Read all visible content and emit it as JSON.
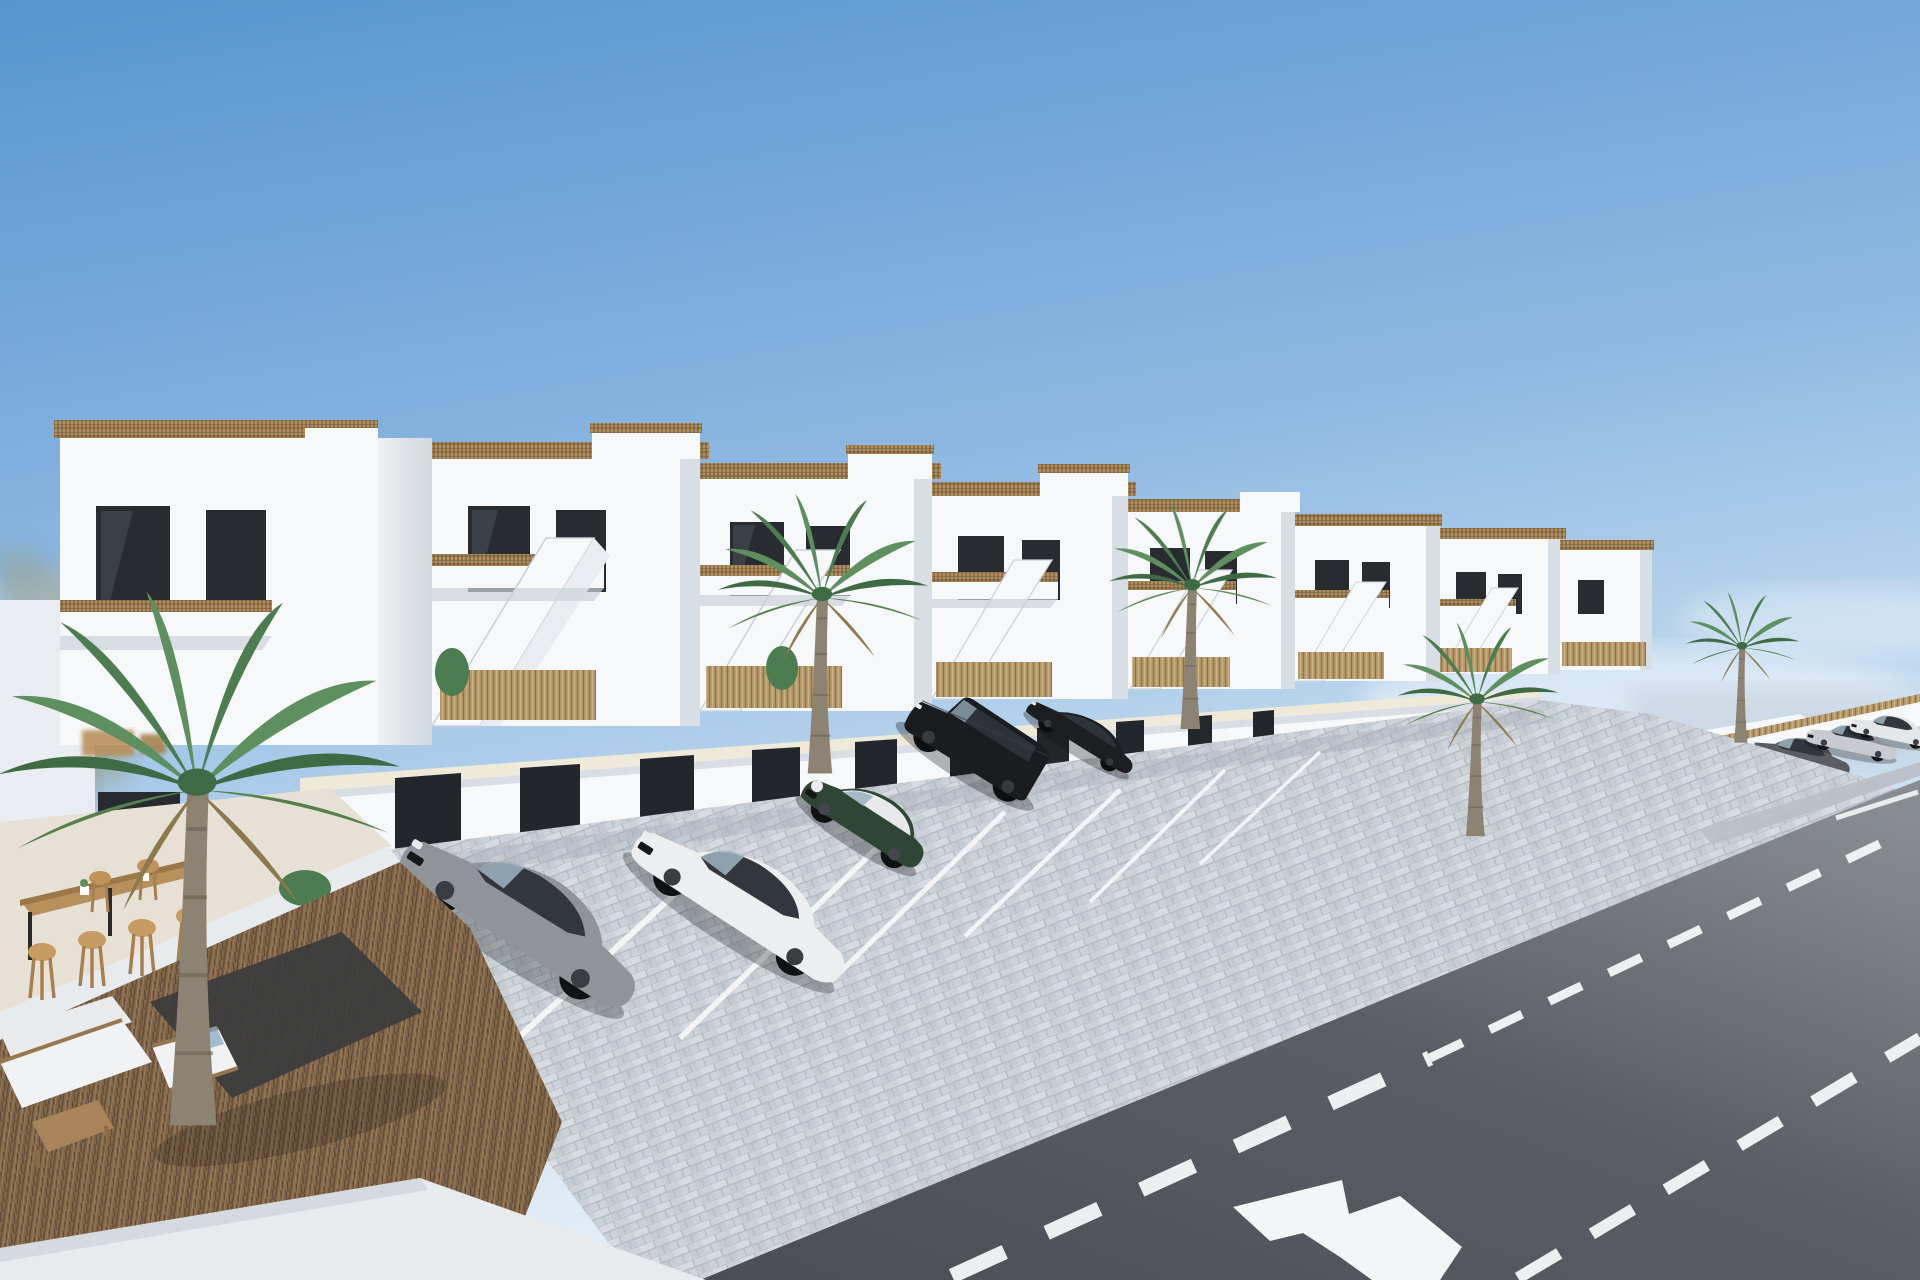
{
  "meta": {
    "description": "3D architectural rendering of a row of modern white two-storey townhouses with roof terraces, external staircases, bamboo balcony railings, garage level with cobbled parking bays, parked cars, palm trees, a private swimming pool with lawn and sun loungers, an outdoor bar terrace, and an asphalt street with white lane markings and a painted merge arrow",
    "image_width": 1920,
    "image_height": 1280,
    "visible_text": "none"
  },
  "palette": {
    "sky-top": "#5795cf",
    "sky-mid": "#9fc4e6",
    "sky-horizon": "#e4eef6",
    "cloud": "#ffffff",
    "hills": "#97a08b",
    "sea-haze": "#c2d2de",
    "building-light": "#f7f8f9",
    "building-mid": "#e9edf1",
    "building-shade": "#d7dee6",
    "building-dark-shade": "#c4ccd7",
    "window-dark": "#282c31",
    "glass-reflect": "#4a535c",
    "railing-tan": "#b4905c",
    "lattice-dark": "#6e5a3e",
    "bamboo": "#b79a6c",
    "garage-door": "#23262a",
    "roof-coping": "#efe9da",
    "terrace-floor": "#e6e1d4",
    "cobble": "#ccd2d8",
    "cobble-gap": "#b3bac1",
    "asphalt-near": "#4b4e54",
    "asphalt-far": "#888d92",
    "road-marking": "#f4f5f6",
    "curb-white": "#e8ebee",
    "sidewalk": "#b9bfc5",
    "palm-green": "#5d8f5f",
    "palm-dark": "#3f6b44",
    "palm-trunk": "#8d8373",
    "brush-brown": "#84674a",
    "brush-dark": "#5d4a36",
    "gravel-dark": "#3b3c3d",
    "wood": "#b9905c",
    "lawn": "#7aa35c",
    "car-gray": "#909499",
    "car-white": "#eceef0",
    "car-green": "#2f4637",
    "car-black": "#1a1c1f",
    "car-silver": "#c7cbd0",
    "shadow": "#0c0d0e"
  },
  "scene": {
    "setting": "sunny coastal residential development, clear blue sky",
    "buildings": {
      "kind": "terraced-townhouse-row",
      "units_visible": 8,
      "features": [
        "roof-terrace-with-lattice-railing",
        "external-staircase",
        "balcony-with-tan-railing",
        "dark-framed-glass-doors",
        "ground-terrace-with-bamboo-screen",
        "garage-row-below"
      ]
    },
    "vehicles": {
      "foreground": [
        "gray-sedan",
        "white-sedan",
        "green-mini-with-white-roof",
        "black-boxy-suv",
        "black-coupe"
      ],
      "distant": [
        "dark-gray-car",
        "silver-sedan",
        "white-sedan"
      ],
      "total_visible": 8
    },
    "vegetation": {
      "palm_trees": 5,
      "shrubs": "small green plants on terraces",
      "ground": "brown brushwood garden in left foreground"
    },
    "amenities": [
      "swimming-pool",
      "lawn-with-two-sun-loungers",
      "outdoor-bar-table",
      "bar-stools",
      "white-lounge-sofa-set",
      "wooden-coffee-table"
    ],
    "road": {
      "surface": "asphalt",
      "markings": [
        "dashed-lane-line-upper",
        "dashed-lane-line-lower",
        "painted-merge-arrow",
        "far-edge-line"
      ],
      "parking": "cobbled parking bays with white divider lines"
    },
    "background": {
      "left": "blurred hillside landscape",
      "right": "hazy sea horizon"
    }
  }
}
